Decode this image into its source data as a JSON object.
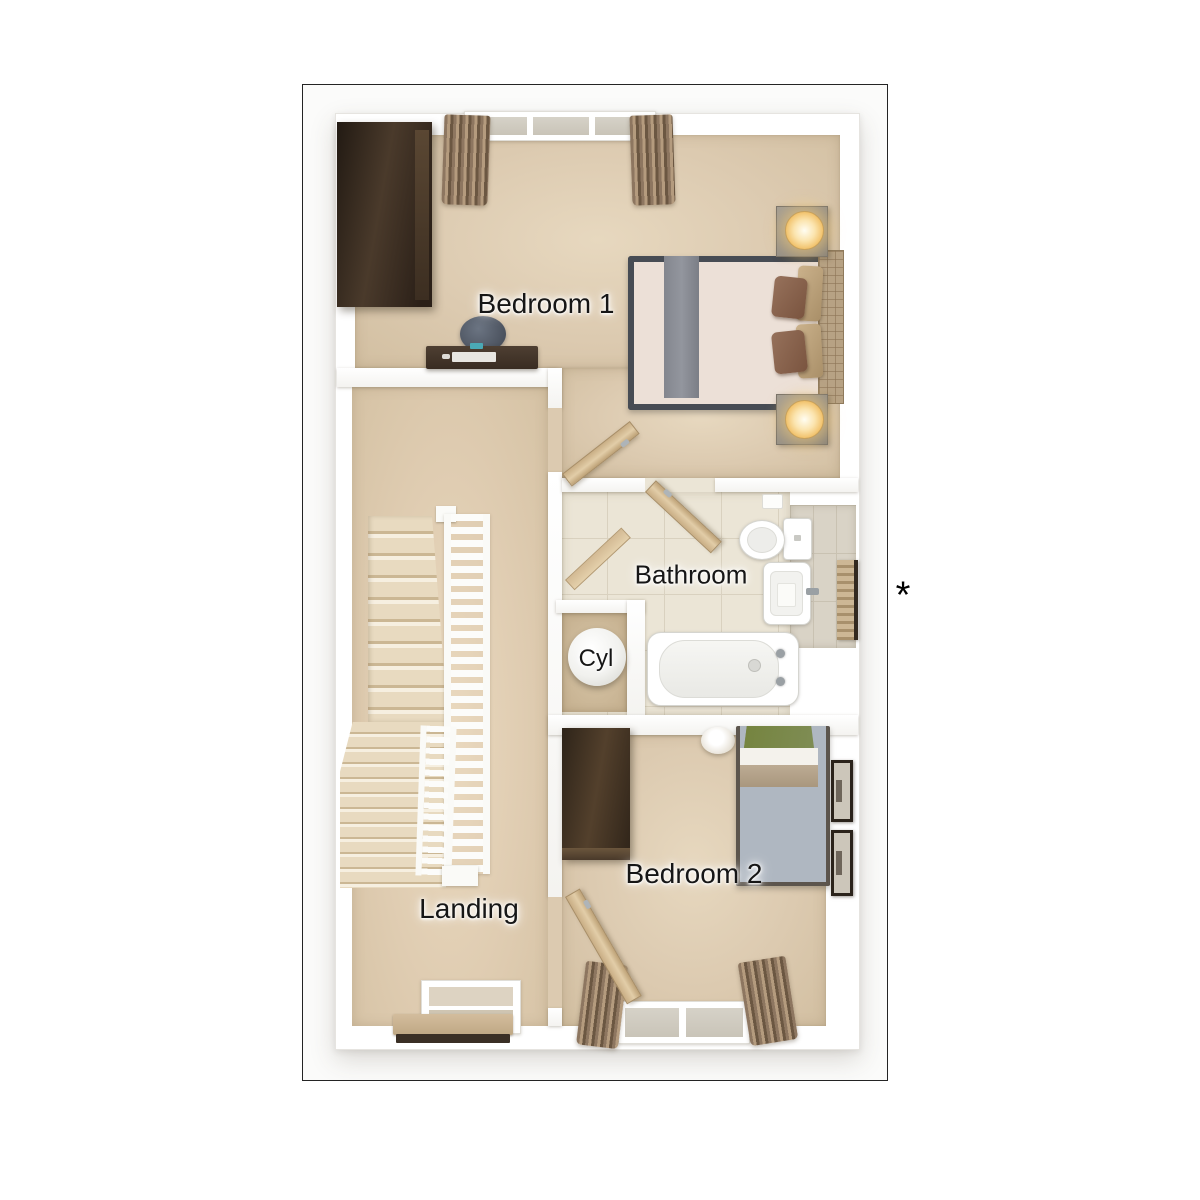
{
  "rooms": [
    {
      "id": "bedroom-1",
      "label": "Bedroom 1"
    },
    {
      "id": "bathroom",
      "label": "Bathroom"
    },
    {
      "id": "cylinder-cupboard",
      "label": "Cyl"
    },
    {
      "id": "bedroom-2",
      "label": "Bedroom 2"
    },
    {
      "id": "landing",
      "label": "Landing"
    }
  ],
  "annotation": {
    "marker": "*"
  },
  "palette": {
    "frame_border": "#242424",
    "wall": "#ffffff",
    "carpet": "#dccab0",
    "bathroom_tile": "#ebe5d6",
    "alcove_tile": "#d9d3c6",
    "dark_wood_wardrobe": "#3a2d21",
    "light_wood_door": "#d6c09b",
    "curtain": "#8d7660",
    "bed1_duvet": "#ece0d7",
    "bed1_runner": "#878a91",
    "bed1_frame": "#474c54",
    "bed2_duvet": "#afb7c1",
    "bed2_throw": "#7c8a51",
    "bed2_band": "#b3a088",
    "lamp_glow": "#f0bd62",
    "porcelain": "#ffffff",
    "radiator_wood": "#cdb795"
  }
}
